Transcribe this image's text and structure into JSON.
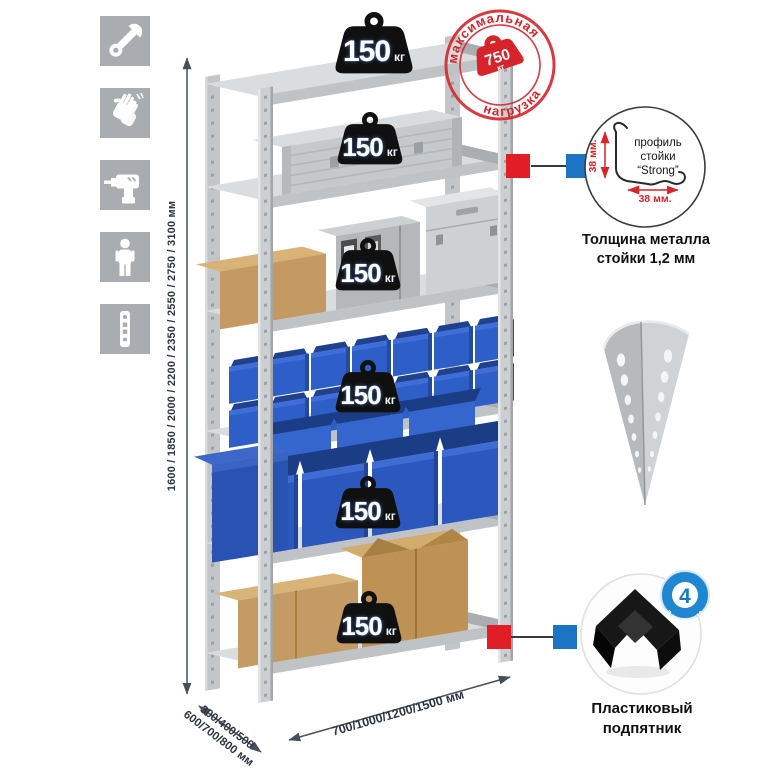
{
  "page": {
    "background": "#ffffff"
  },
  "sidebar": {
    "icons": [
      {
        "name": "wrench"
      },
      {
        "name": "gloves"
      },
      {
        "name": "drill"
      },
      {
        "name": "person"
      },
      {
        "name": "rack-profile-strip"
      }
    ]
  },
  "rack": {
    "shelf_count": 6,
    "shelf_load_value": "150",
    "shelf_load_unit": "кг"
  },
  "stamp": {
    "arc_top": "максимальная",
    "arc_bottom": "нагрузка",
    "value": "750",
    "unit": "кг"
  },
  "dimensions": {
    "height": "1600 / 1850 / 2000 / 2200 / 2350 / 2550 / 2750 / 3100 мм",
    "width": "700/1000/1200/1500 мм",
    "depth_line1": "300/400/500",
    "depth_line2": "600/700/800 мм"
  },
  "profile_detail": {
    "label_line1": "профиль",
    "label_line2": "стойки",
    "label_line3": "“Strong”",
    "dim_vertical": "38 мм.",
    "dim_horizontal": "38 мм.",
    "caption_line1": "Толщина металла",
    "caption_line2": "стойки 1,2 мм"
  },
  "foot_detail": {
    "badge_count": "4",
    "badge_arc": "в комплекте",
    "caption_line1": "Пластиковый",
    "caption_line2": "подпятник"
  },
  "colors": {
    "stamp_red": "#d8232a",
    "marker_red": "#e11d26",
    "marker_blue": "#1c74c4",
    "bin_blue": "#2f5fc8",
    "metal_gray": "#cbcfd1",
    "tile_gray": "#a9acb0",
    "badge_blue": "#1f86d2",
    "dim_text": "#2b3642"
  }
}
